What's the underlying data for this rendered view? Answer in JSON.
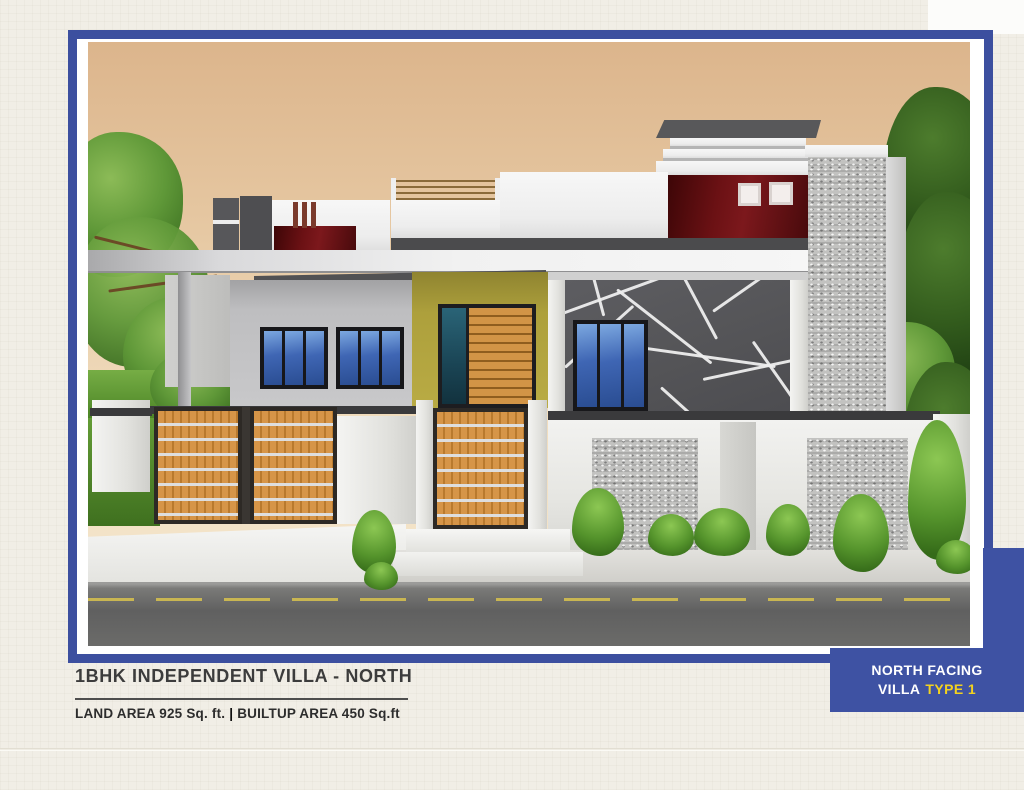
{
  "caption": {
    "title": "1BHK INDEPENDENT VILLA - NORTH",
    "land_area": "LAND AREA 925 Sq. ft.",
    "separator": "|",
    "builtup_area": "BUILTUP AREA 450 Sq.ft"
  },
  "badge": {
    "line1": "NORTH FACING",
    "line2_prefix": "VILLA",
    "line2_highlight": "TYPE 1",
    "bg_color": "#3e52a3",
    "text_color": "#ffffff",
    "highlight_color": "#f2d21f"
  },
  "frame": {
    "border_color": "#3c4f9f"
  },
  "illustration_colors": {
    "sky_top": "#dcb58c",
    "sky_bottom": "#f6ead2",
    "accent_maroon": "#6b1114",
    "wall_yellow": "#b3a53f",
    "wood": "#c8883a",
    "feature_wall": "#56565a",
    "glass_blue": "#3f66b4",
    "road": "#5f5f5d"
  }
}
